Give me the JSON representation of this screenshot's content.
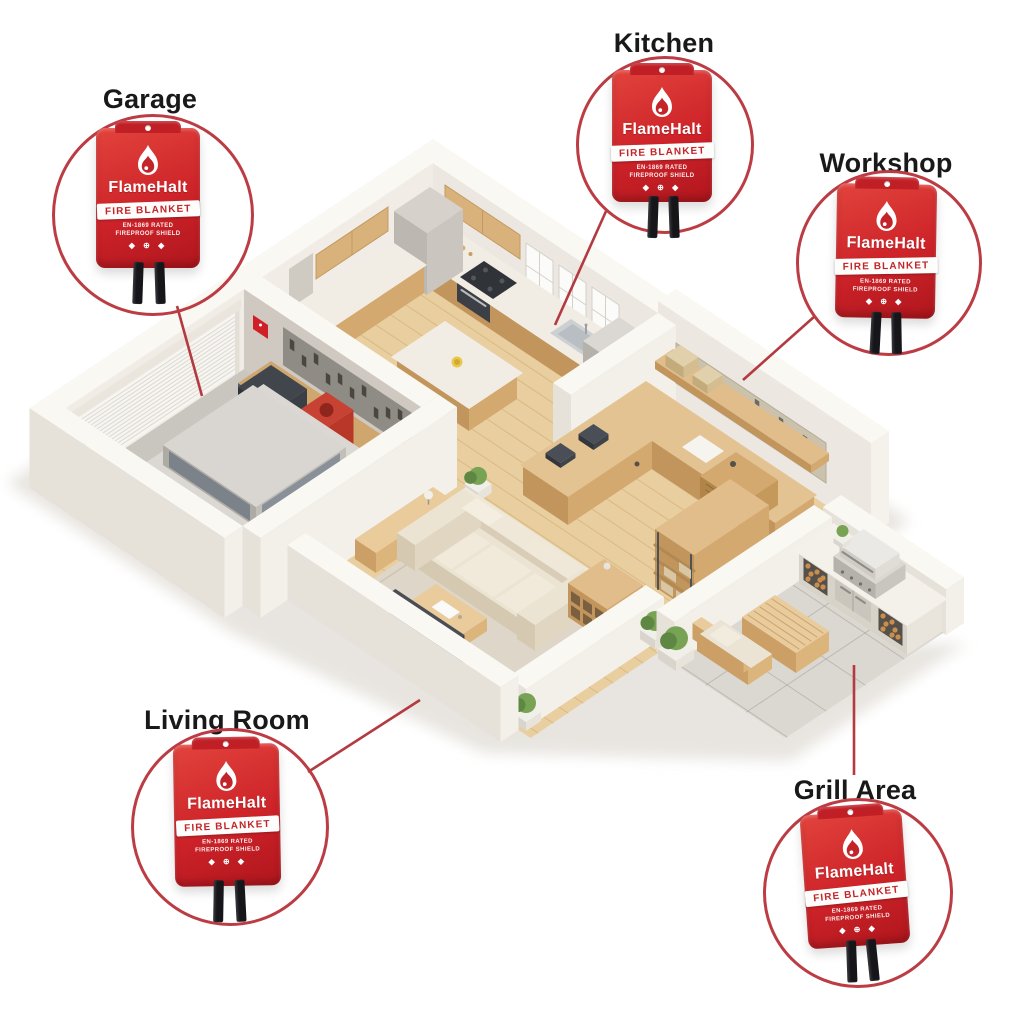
{
  "product": {
    "brand": "FlameHalt",
    "name": "FIRE BLANKET",
    "fine_print_line1": "EN-1869 RATED",
    "fine_print_line2": "FIREPROOF SHIELD",
    "cert_icons": "◆ ⊕ ◆"
  },
  "callouts": [
    {
      "id": "garage",
      "label": "Garage"
    },
    {
      "id": "kitchen",
      "label": "Kitchen"
    },
    {
      "id": "workshop",
      "label": "Workshop"
    },
    {
      "id": "living-room",
      "label": "Living Room"
    },
    {
      "id": "grill-area",
      "label": "Grill Area"
    }
  ],
  "colors": {
    "accent_red": "#c3242a",
    "ring_red": "#bc3c44",
    "line_red": "#b23a40",
    "package_red": "#cd2329",
    "label_text": "#191919",
    "background": "#ffffff"
  },
  "scene": {
    "type": "isometric-floor-plan",
    "rooms": [
      {
        "name": "Garage",
        "items": [
          "car",
          "roller-door",
          "workbench",
          "pegboard-tools",
          "red-barrel",
          "fire-extinguisher",
          "shop-vacuum",
          "toolbox",
          "broom"
        ]
      },
      {
        "name": "Kitchen",
        "items": [
          "cabinets",
          "cooktop",
          "oven",
          "sink",
          "windows",
          "refrigerator",
          "island",
          "bar-stools",
          "fruit-bowl",
          "cutting-boards"
        ]
      },
      {
        "name": "Workshop",
        "items": [
          "l-shaped-workbench",
          "pegboard",
          "wall-shelf",
          "storage-rack",
          "drawer-unit",
          "tools"
        ]
      },
      {
        "name": "Living Room",
        "items": [
          "sofa",
          "throw-pillows",
          "rug",
          "coffee-table",
          "tv",
          "media-console",
          "sideboard",
          "cube-shelf",
          "potted-plants"
        ]
      },
      {
        "name": "Grill Area",
        "items": [
          "bbq-grill",
          "outdoor-counter",
          "firewood-storage",
          "outdoor-table",
          "bench",
          "potted-plants",
          "concrete-patio"
        ]
      }
    ]
  }
}
